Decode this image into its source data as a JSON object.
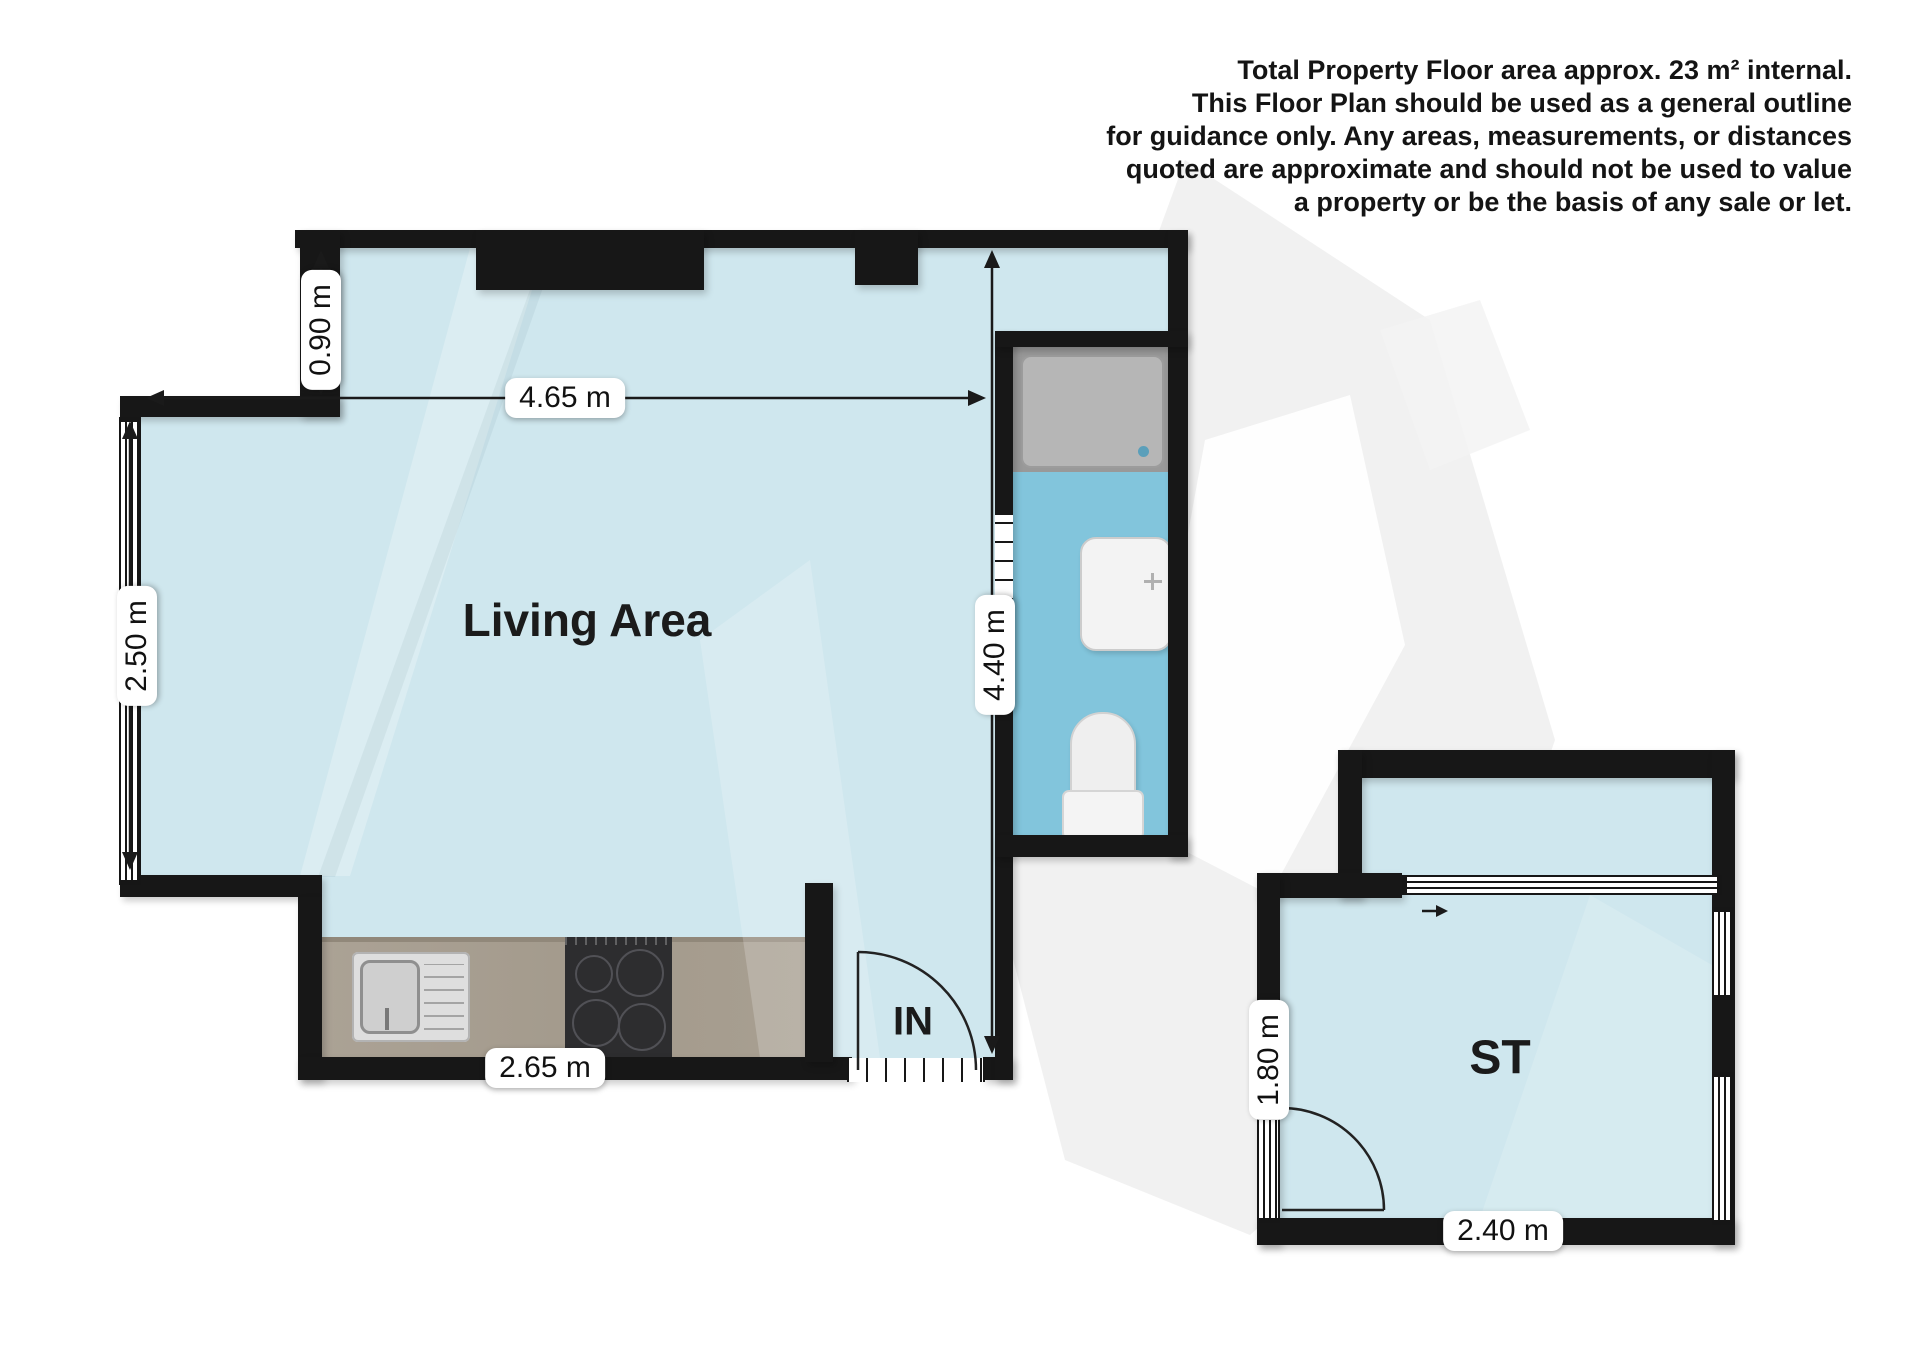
{
  "disclaimer": {
    "lines": [
      "Total Property Floor area approx. 23 m² internal.",
      "This Floor Plan should be used as a general outline",
      "for guidance only. Any areas, measurements, or distances",
      "quoted are approximate and should not be used to value",
      "a property or be the basis of any sale or let."
    ]
  },
  "rooms": {
    "living_area": "Living Area",
    "entrance": "IN",
    "storage": "ST"
  },
  "dimensions": {
    "notch_height": "0.90 m",
    "living_width": "4.65 m",
    "window_height": "2.50 m",
    "unit_depth": "4.40 m",
    "kitchen_width": "2.65 m",
    "storage_depth": "1.80 m",
    "storage_width": "2.40 m"
  },
  "colors": {
    "wall": "#171717",
    "living_floor": "#cfe7ee",
    "bathroom_floor": "#82c5dc",
    "storage_floor": "#cfe7ee",
    "kitchen_counter": "#a89f91",
    "hob": "#2d2d2f",
    "shower_tray": "#b4b4b4",
    "label_background": "#ffffff",
    "text": "#111111"
  }
}
